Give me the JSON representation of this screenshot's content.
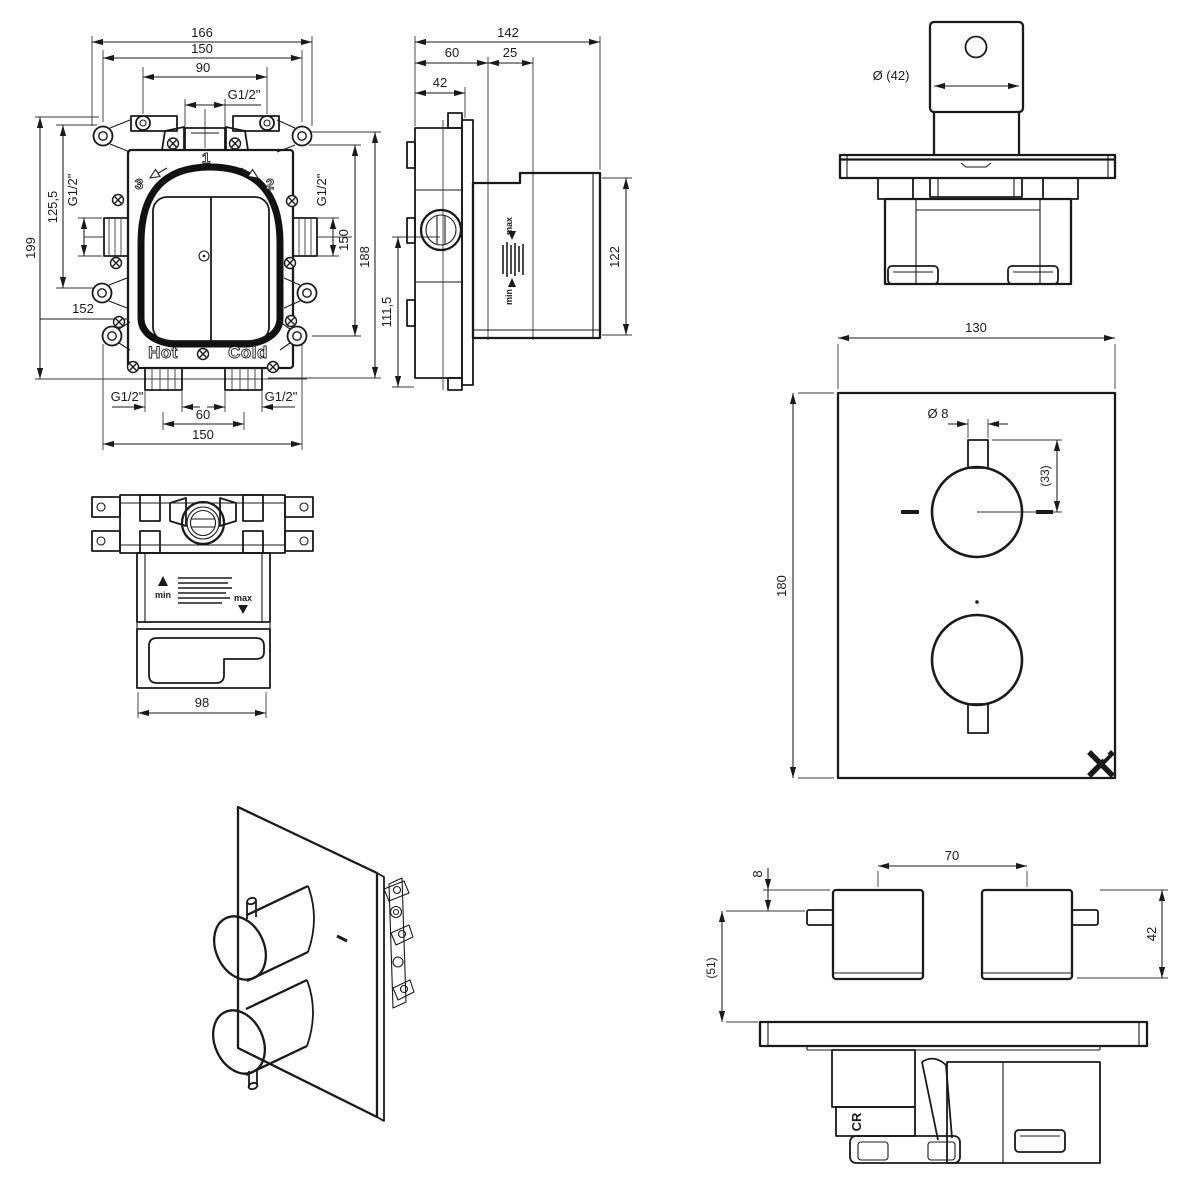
{
  "views": {
    "box_front": {
      "dim_width_overall": "166",
      "dim_width_fixing": "150",
      "dim_width_ports": "90",
      "thread_top": "G1/2\"",
      "dim_height_overall": "199",
      "dim_height_upper": "125,5",
      "thread_left": "G1/2\"",
      "dim_152": "152",
      "thread_right": "G1/2\"",
      "dim_height_fixing": "150",
      "dim_height_body": "188",
      "port_1": "1",
      "port_2": "2",
      "port_3": "3",
      "label_hot": "Hot",
      "label_cold": "Cold",
      "thread_bottom_left": "G1/2\"",
      "thread_bottom_right": "G1/2\"",
      "dim_bottom_spacing": "60",
      "dim_bottom_fixing": "150"
    },
    "box_side": {
      "dim_depth_overall": "142",
      "dim_depth_box": "60",
      "dim_adjust_range": "25",
      "dim_front_depth": "42",
      "dim_height_lower": "111,5",
      "dim_height_body": "122",
      "label_min": "min",
      "label_max": "max"
    },
    "trim_side": {
      "dim_knob_dia": "Ø (42)"
    },
    "plate_front": {
      "dim_plate_width": "130",
      "dim_plate_height": "180",
      "dim_stem_dia": "Ø 8",
      "dim_stem_len": "(33)"
    },
    "box_top": {
      "dim_body_width": "98",
      "label_min": "min",
      "label_max": "max"
    },
    "trim_top": {
      "dim_knob_spacing": "70",
      "dim_pin_offset": "8",
      "dim_knob_dia": "42",
      "dim_knob_proj": "(51)",
      "logo_cr": "CR"
    }
  }
}
